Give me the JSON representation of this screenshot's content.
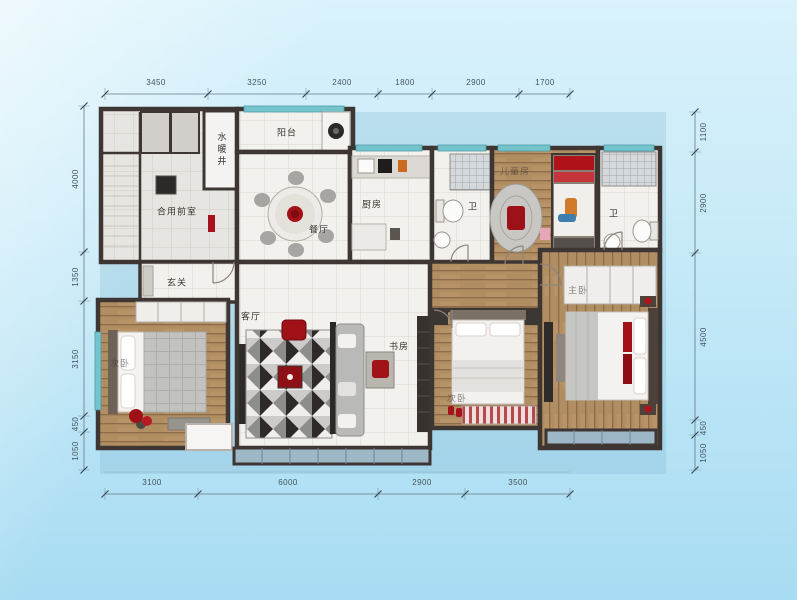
{
  "dims": {
    "top": [
      "3450",
      "3250",
      "2400",
      "1800",
      "2900",
      "1700"
    ],
    "bottom": [
      "3100",
      "6000",
      "2900",
      "3500"
    ],
    "left": [
      "4000",
      "1350",
      "3150",
      "450",
      "1050"
    ],
    "right": [
      "1100",
      "2900",
      "4500",
      "450",
      "1050"
    ]
  },
  "rooms": {
    "shaft": "水暖井",
    "vestibule": "合用前室",
    "balcony": "阳台",
    "dining": "餐厅",
    "kitchen": "厨房",
    "bath_a": "卫",
    "kids": "儿童房",
    "bath_b": "卫",
    "entry": "玄关",
    "living": "客厅",
    "study": "书房",
    "bedroom_left": "次卧",
    "bedroom_mid": "次卧",
    "master": "主卧"
  },
  "colors": {
    "background_top": "#d9f2fb",
    "background_bottom": "#a8dcf2",
    "wall": "#3e3633",
    "tile_floor": "#f2f1ee",
    "wood_floor": "#b18d62",
    "window_glass": "#74c4cd",
    "balcony_glass": "#9db7c6",
    "accent_red": "#a8121a",
    "dimension_text": "#45535f"
  }
}
